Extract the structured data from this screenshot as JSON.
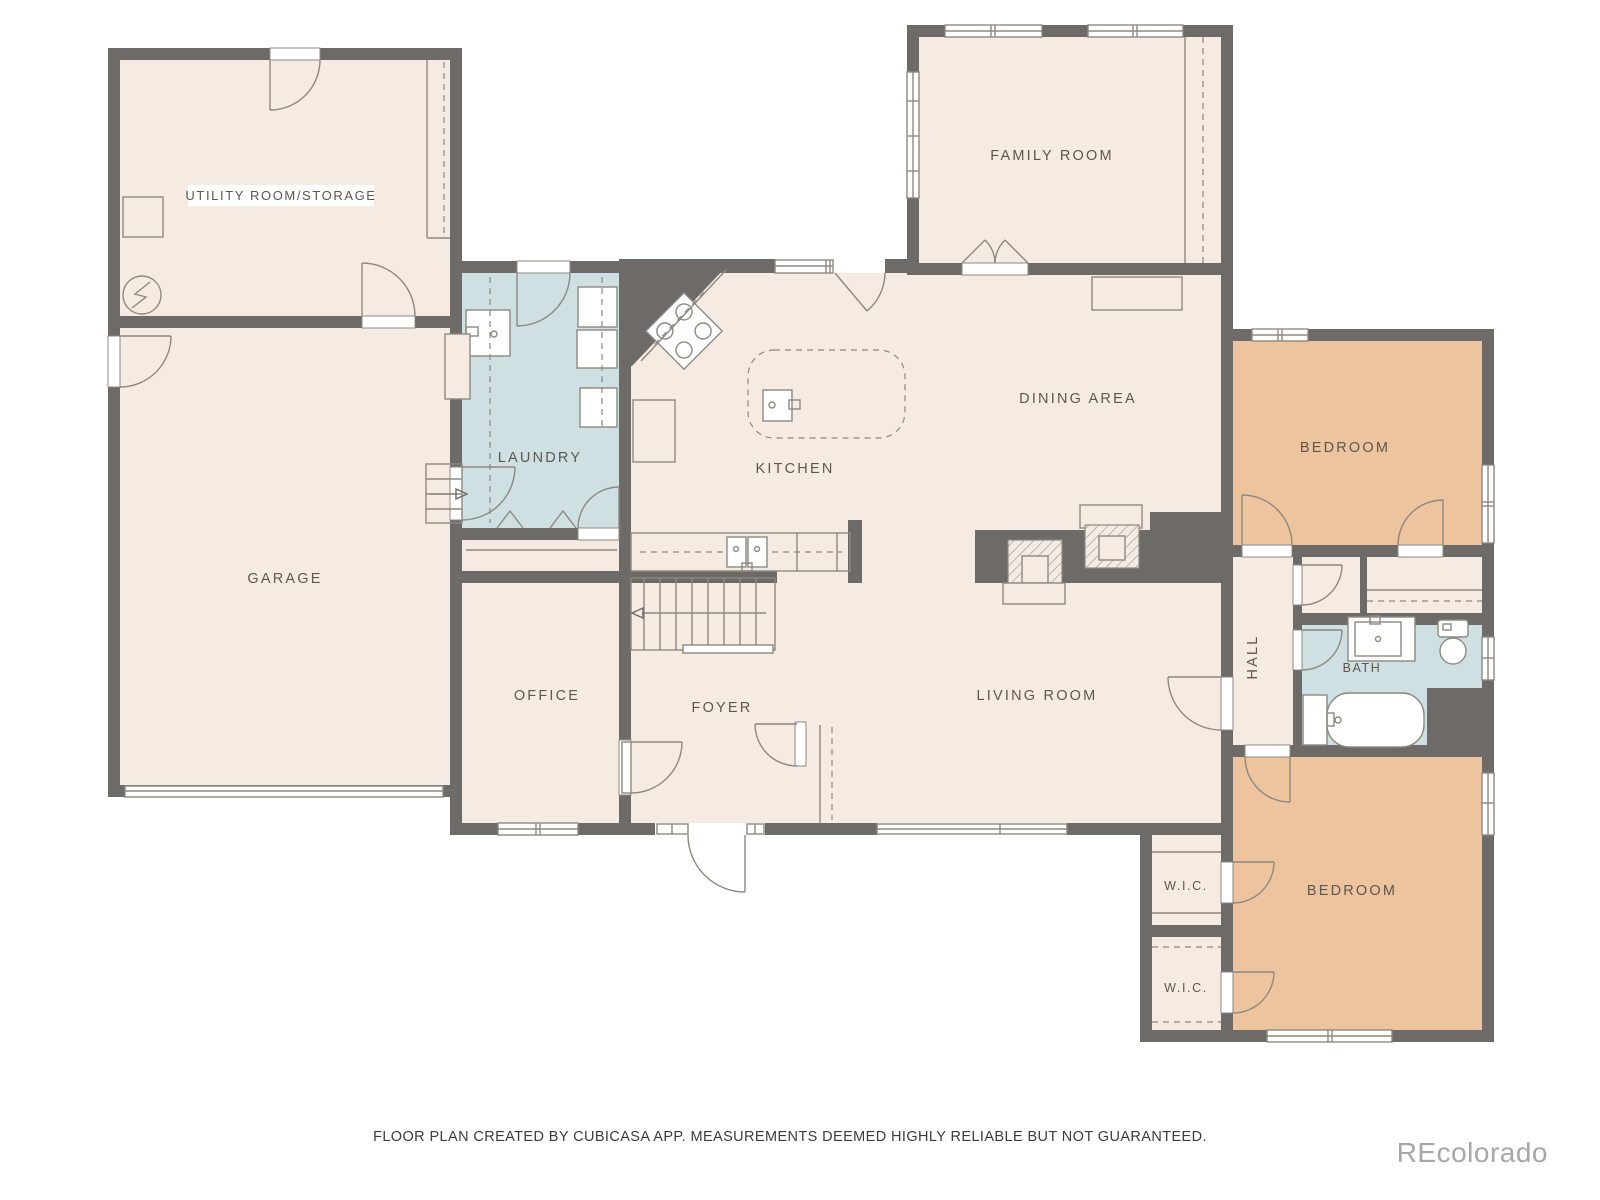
{
  "rooms": {
    "utility": {
      "label": "UTILITY ROOM/STORAGE"
    },
    "garage": {
      "label": "GARAGE"
    },
    "laundry": {
      "label": "LAUNDRY"
    },
    "kitchen": {
      "label": "KITCHEN"
    },
    "dining": {
      "label": "DINING AREA"
    },
    "family": {
      "label": "FAMILY ROOM"
    },
    "bedroom1": {
      "label": "BEDROOM"
    },
    "bedroom2": {
      "label": "BEDROOM"
    },
    "hall": {
      "label": "HALL"
    },
    "bath": {
      "label": "BATH"
    },
    "wic1": {
      "label": "W.I.C."
    },
    "wic2": {
      "label": "W.I.C."
    },
    "office": {
      "label": "OFFICE"
    },
    "foyer": {
      "label": "FOYER"
    },
    "living": {
      "label": "LIVING ROOM"
    }
  },
  "footer": {
    "disclaimer": "FLOOR PLAN CREATED BY CUBICASA APP. MEASUREMENTS DEEMED HIGHLY RELIABLE BUT NOT GUARANTEED."
  },
  "watermark": {
    "text": "REcolorado"
  },
  "colors": {
    "wall": "#6d6a67",
    "floor": "#f6ebe3",
    "wet": "#cfe0e2",
    "bedroom": "#edc49e",
    "line": "#8d8880",
    "label": "#5d574d",
    "footer": "#3c3c3c",
    "watermark": "#a7a7a7",
    "background": "#ffffff"
  }
}
